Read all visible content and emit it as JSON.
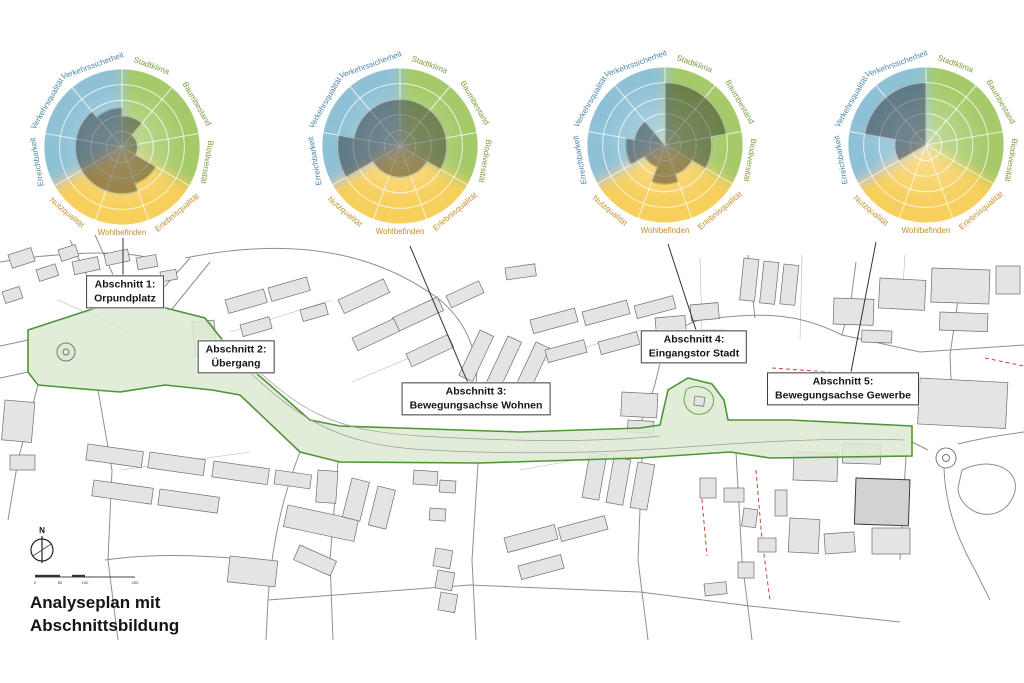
{
  "page": {
    "title_line1": "Analyseplan mit",
    "title_line2": "Abschnittsbildung"
  },
  "compass": {
    "label": "N"
  },
  "scalebar": {
    "ticks": [
      "0",
      "50",
      "100",
      "200"
    ]
  },
  "colors": {
    "sector_blue": "#8fc1d6",
    "sector_green": "#a6ca6b",
    "sector_yellow": "#f6cf5c",
    "label_blue": "#4d87a8",
    "label_green": "#7b9c3f",
    "label_orange": "#c28f2c",
    "data_fill": "#1f1f1f",
    "green_zone_fill": "#dcead2",
    "green_zone_stroke": "#4e9633",
    "red_dash": "#cc4433"
  },
  "sections": [
    {
      "label_line1": "Abschnitt 1:",
      "label_line2": "Orpundplatz"
    },
    {
      "label_line1": "Abschnitt 2:",
      "label_line2": "Übergang"
    },
    {
      "label_line1": "Abschnitt 3:",
      "label_line2": "Bewegungsachse Wohnen"
    },
    {
      "label_line1": "Abschnitt 4:",
      "label_line2": "Eingangstor Stadt"
    },
    {
      "label_line1": "Abschnitt 5:",
      "label_line2": "Bewegungsachse Gewerbe"
    }
  ],
  "chart_data": [
    {
      "type": "polar-sector",
      "links_to": "Abschnitt 1: Orpundplatz",
      "categories": [
        "Stadtklima",
        "Baumbestand",
        "Biodiversität",
        "Erlebnisqualität",
        "Wohlbefinden",
        "Nutzqualität",
        "Erreichbarkeit",
        "Verkehrsqualität",
        "Verkehrssicherheit"
      ],
      "groups": [
        "green",
        "green",
        "green",
        "yellow",
        "yellow",
        "yellow",
        "blue",
        "blue",
        "blue"
      ],
      "values": [
        2,
        1,
        1,
        2.5,
        3,
        3,
        3,
        3,
        2.5
      ],
      "rmax": 5,
      "rings": 5,
      "legend_position": "none",
      "grid": true
    },
    {
      "type": "polar-sector",
      "links_to": "Abschnitt 3: Bewegungsachse Wohnen",
      "categories": [
        "Stadtklima",
        "Baumbestand",
        "Biodiversität",
        "Erlebnisqualität",
        "Wohlbefinden",
        "Nutzqualität",
        "Erreichbarkeit",
        "Verkehrsqualität",
        "Verkehrssicherheit"
      ],
      "groups": [
        "green",
        "green",
        "green",
        "yellow",
        "yellow",
        "yellow",
        "blue",
        "blue",
        "blue"
      ],
      "values": [
        3,
        3,
        3,
        2,
        2,
        2,
        4,
        3,
        3
      ],
      "rmax": 5,
      "rings": 5,
      "legend_position": "none",
      "grid": true
    },
    {
      "type": "polar-sector",
      "links_to": "Abschnitt 4: Eingangstor Stadt",
      "categories": [
        "Stadtklima",
        "Baumbestand",
        "Biodiversität",
        "Erlebnisqualität",
        "Wohlbefinden",
        "Nutzqualität",
        "Erreichbarkeit",
        "Verkehrsqualität",
        "Verkehrssicherheit"
      ],
      "groups": [
        "green",
        "green",
        "green",
        "yellow",
        "yellow",
        "yellow",
        "blue",
        "blue",
        "blue"
      ],
      "values": [
        4,
        4,
        3,
        2,
        2.5,
        1.5,
        2.5,
        2,
        0
      ],
      "rmax": 5,
      "rings": 5,
      "legend_position": "none",
      "grid": true
    },
    {
      "type": "polar-sector",
      "links_to": "Abschnitt 5: Bewegungsachse Gewerbe",
      "categories": [
        "Stadtklima",
        "Baumbestand",
        "Biodiversität",
        "Erlebnisqualität",
        "Wohlbefinden",
        "Nutzqualität",
        "Erreichbarkeit",
        "Verkehrsqualität",
        "Verkehrssicherheit"
      ],
      "groups": [
        "green",
        "green",
        "green",
        "yellow",
        "yellow",
        "yellow",
        "blue",
        "blue",
        "blue"
      ],
      "values": [
        0,
        0,
        0,
        0,
        0,
        0,
        2,
        4,
        4
      ],
      "rmax": 5,
      "rings": 5,
      "legend_position": "none",
      "grid": true
    }
  ]
}
